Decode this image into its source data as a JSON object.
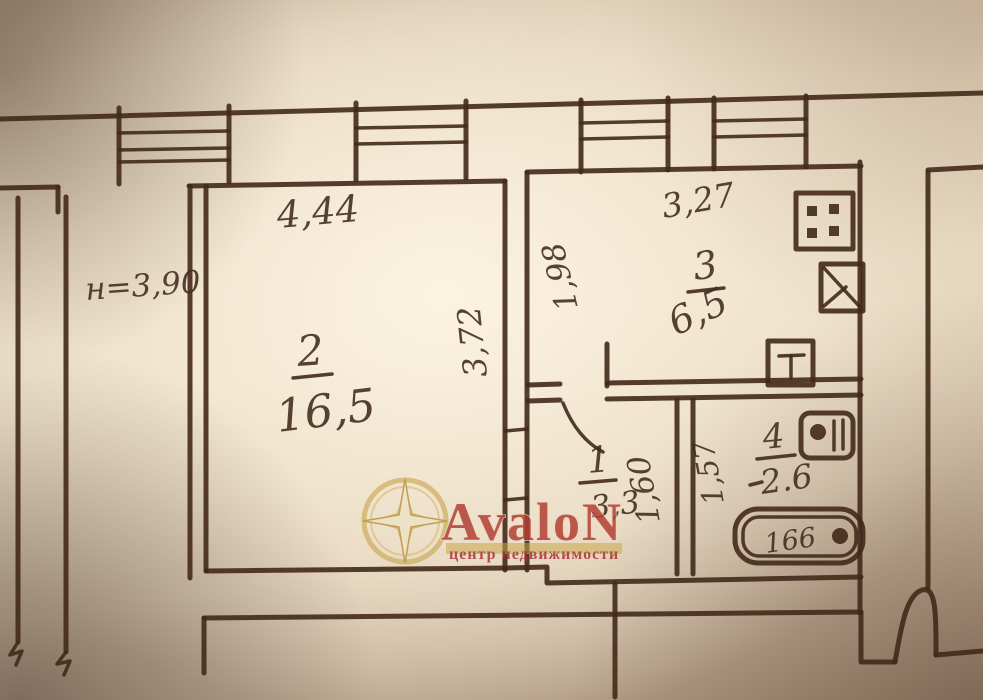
{
  "photo_plan": {
    "watermark": {
      "brand": "AvaloN",
      "tagline": "центр недвижимости",
      "accent_color": "#b23b32",
      "gold_color": "#c6a64e"
    },
    "dimensions": {
      "room2_width": "4,44",
      "ceiling_height": "н=3,90",
      "room2_depth": "3,72",
      "kitchen_depth": "1,98",
      "kitchen_width": "3,27",
      "hall_width": "1,60",
      "bath_depth": "1,57",
      "bathtub_length": "166"
    },
    "rooms": {
      "living": {
        "number": "2",
        "area": "16,5"
      },
      "kitchen": {
        "number": "3",
        "area": "6,5"
      },
      "hall": {
        "number": "1",
        "area": "3,3"
      },
      "bath": {
        "number": "4",
        "area": "2.6"
      }
    }
  }
}
